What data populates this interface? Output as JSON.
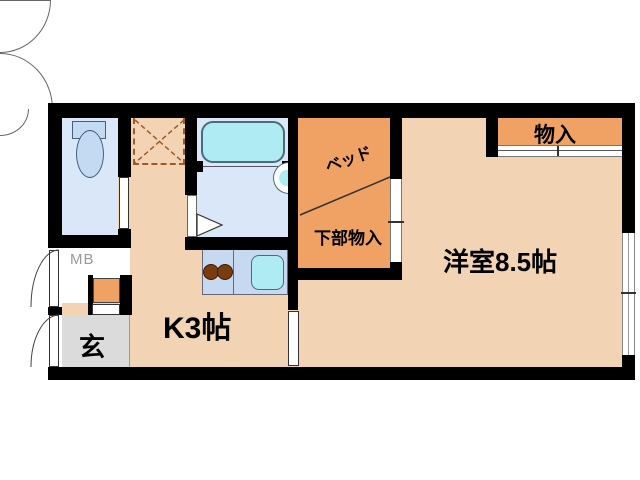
{
  "plan": {
    "type": "apartment-floor-plan",
    "rooms": {
      "western_room": {
        "label": "洋室8.5帖"
      },
      "kitchen": {
        "label": "K3帖"
      },
      "bed_alcove": {
        "label": "ベッド"
      },
      "under_bed_storage": {
        "label": "下部物入"
      },
      "closet": {
        "label": "物入"
      },
      "entrance": {
        "label": "玄"
      },
      "meter_box": {
        "label": "MB"
      }
    },
    "colors": {
      "floor_main": "#f2d3b4",
      "floor_accent_orange": "#efa263",
      "wet_area_blue": "#d9e7f8",
      "fixture_cyan": "#aeebf2",
      "counter_blue": "#c6d9f0",
      "entrance_gray": "#dbdbdb",
      "wall_black": "#000000",
      "dashed_marking": "#a05a2a",
      "burner_brown": "#7a3b10",
      "mb_text_gray": "#999999"
    }
  }
}
